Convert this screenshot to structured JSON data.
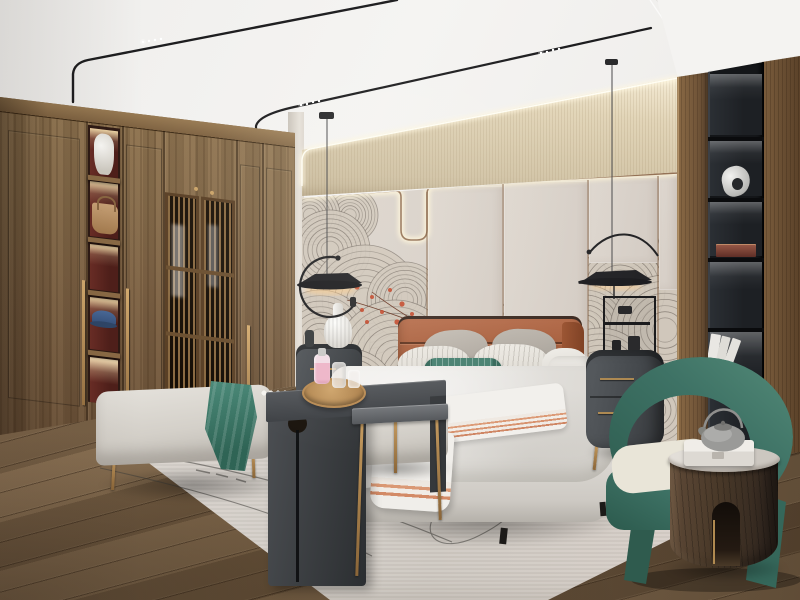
{
  "meta": {
    "width": 800,
    "height": 600,
    "kind": "photorealistic interior render",
    "visible_text": "none"
  },
  "scene": {
    "room": "modern chinese style bedroom",
    "objects": [
      {
        "name": "ceiling",
        "desc": "white tray ceiling with recessed border"
      },
      {
        "name": "track-lights",
        "desc": "two thin black magnetic tracks curving down the wall, with tiny led spot clusters"
      },
      {
        "name": "cove-lighting",
        "desc": "warm led strip washing the beige textured upper wall"
      },
      {
        "name": "upper-wall",
        "desc": "beige vertically striated fabric band"
      },
      {
        "name": "headboard-wall",
        "desc": "greige panels with backlit brass trim that dips in a U notch"
      },
      {
        "name": "mural",
        "desc": "hand-drawn fan / wave swirl motifs with small red blossom accents"
      },
      {
        "name": "wardrobe",
        "desc": "walnut wardrobe: plain doors, slatted lattice doors, long brass pulls"
      },
      {
        "name": "wardrobe-display",
        "desc": "lit cubbies with red backs: white vase, tan handbag, blue cap"
      },
      {
        "name": "black-niche",
        "desc": "recessed black shelving column with led shelves: sculpture, wooden box, white books"
      },
      {
        "name": "pendant-lamps",
        "desc": "pair of black flat-disc pendants with arc arms on thin cables"
      },
      {
        "name": "bed",
        "desc": "upholstered bed, terracotta leather channel headboard, white-gray bedding"
      },
      {
        "name": "pillows",
        "desc": "gray euro pillows, pinstripe pillows, teal lumbar, white bolster"
      },
      {
        "name": "throw",
        "desc": "white runner blanket with salmon stripes"
      },
      {
        "name": "nightstands",
        "desc": "rounded charcoal nightstands with brass pulls and legs"
      },
      {
        "name": "vase-lamp",
        "desc": "white ribbed ceramic vase on left nightstand"
      },
      {
        "name": "tea-rack",
        "desc": "black open display stand on right nightstand"
      },
      {
        "name": "bench",
        "desc": "light gray bench and ottoman with slender brass legs"
      },
      {
        "name": "teal-throw",
        "desc": "teal knit throw draped over bench"
      },
      {
        "name": "waterfall-table",
        "desc": "charcoal sheet-metal waterfall table with round cutout"
      },
      {
        "name": "tray",
        "desc": "round wooden tray with pink perfume bottles and glasses"
      },
      {
        "name": "c-table",
        "desc": "gray-top side table on thin brass legs"
      },
      {
        "name": "rug",
        "desc": "pale greige area rug with thin dark curved line motif"
      },
      {
        "name": "pinecones",
        "desc": "two pinecones resting on the rug"
      },
      {
        "name": "armchair",
        "desc": "green barrel armchair with cream seat cushion"
      },
      {
        "name": "drum-table",
        "desc": "dark walnut drum side table, marble top, arched cutout"
      },
      {
        "name": "teapot",
        "desc": "gray clay teapot with metal bail handle on marble box"
      },
      {
        "name": "floor",
        "desc": "diagonal oak plank flooring"
      }
    ],
    "palette": {
      "ceiling": "#f1f0ee",
      "cove_glow": "#fff3d2",
      "wall_beige": "#ddcfb2",
      "wall_panel": "#d9d2ca",
      "trim_brass": "#8a6548",
      "mural_line": "#5e564e",
      "mural_base": "#cfc6ba",
      "accent_red": "#c2472a",
      "wood_wardrobe": "#7c6143",
      "lattice_dark": "#1d1409",
      "niche_black": "#1b1d20",
      "wood_right": "#74573a",
      "floor_wood": "#6e5940",
      "rug": "#d6d1cb",
      "rug_line": "#42403c",
      "headboard_terracotta": "#a45b3a",
      "bedding_white": "#eceae6",
      "pillow_gray": "#b7b1a9",
      "accent_teal": "#3f7a6a",
      "throw_stripe": "#d8936f",
      "nightstand_gray": "#4b4f53",
      "brass": "#b08d58",
      "chair_green": "#3e7265",
      "cushion_cream": "#e9e5d8",
      "drum_walnut": "#4a3a2d",
      "marble": "#dcd8d2",
      "teapot_clay": "#8b8b89",
      "bottle_pink": "#eab6c4"
    }
  }
}
